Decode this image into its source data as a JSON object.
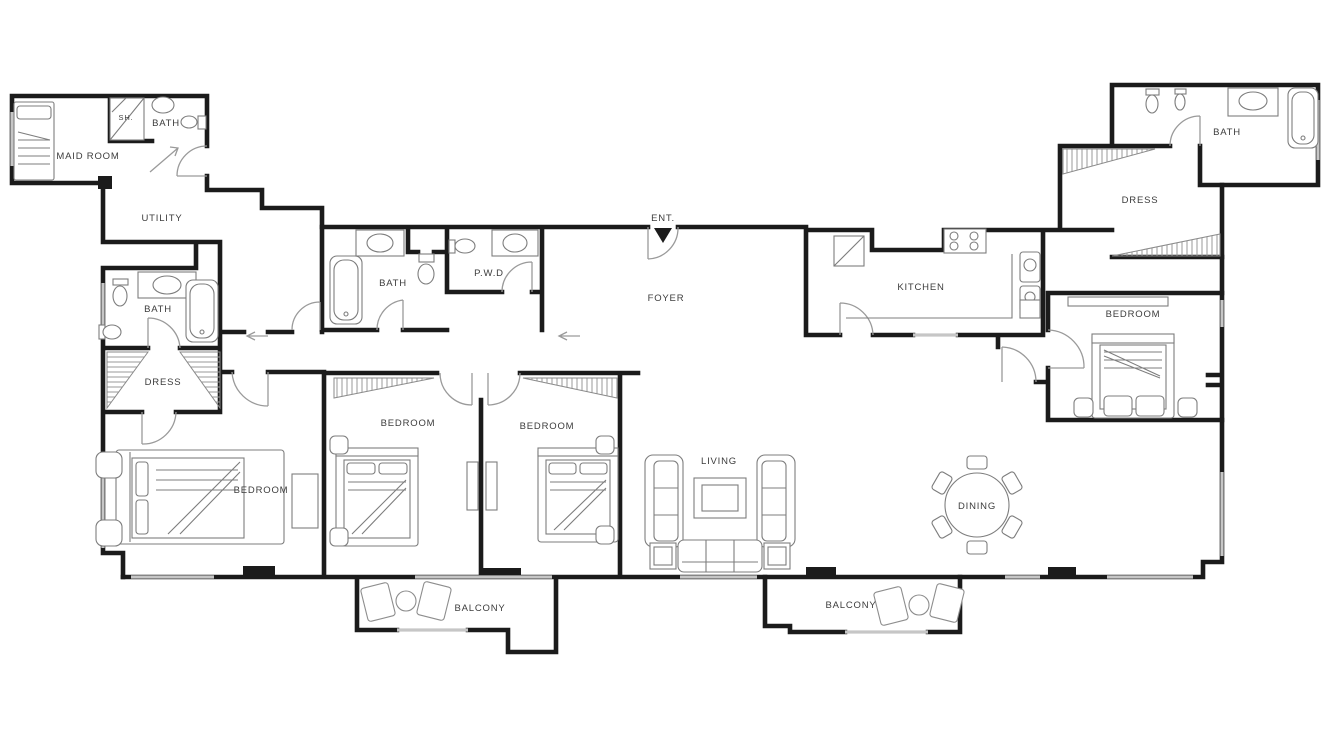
{
  "plan": {
    "type": "apartment floor plan",
    "colors": {
      "wall": "#1b1b1b",
      "window": "#c6c6c6",
      "door_arc": "#9a9a9a",
      "furniture": "#7d7d7d",
      "label": "#3c3c3c",
      "background": "#ffffff"
    },
    "rooms": [
      {
        "id": "maid-room",
        "label": "MAID ROOM"
      },
      {
        "id": "shower",
        "label": "SH."
      },
      {
        "id": "maid-bath",
        "label": "BATH"
      },
      {
        "id": "utility",
        "label": "UTILITY"
      },
      {
        "id": "bath-left",
        "label": "BATH"
      },
      {
        "id": "dress-left",
        "label": "DRESS"
      },
      {
        "id": "bath-center",
        "label": "BATH"
      },
      {
        "id": "powder-room",
        "label": "P.W.D"
      },
      {
        "id": "entrance",
        "label": "ENT."
      },
      {
        "id": "foyer",
        "label": "FOYER"
      },
      {
        "id": "kitchen",
        "label": "KITCHEN"
      },
      {
        "id": "dress-right",
        "label": "DRESS"
      },
      {
        "id": "bath-right",
        "label": "BATH"
      },
      {
        "id": "bedroom-right",
        "label": "BEDROOM"
      },
      {
        "id": "bedroom-master",
        "label": "BEDROOM"
      },
      {
        "id": "bedroom-2",
        "label": "BEDROOM"
      },
      {
        "id": "bedroom-3",
        "label": "BEDROOM"
      },
      {
        "id": "living",
        "label": "LIVING"
      },
      {
        "id": "dining",
        "label": "DINING"
      },
      {
        "id": "balcony-left",
        "label": "BALCONY"
      },
      {
        "id": "balcony-right",
        "label": "BALCONY"
      }
    ]
  }
}
